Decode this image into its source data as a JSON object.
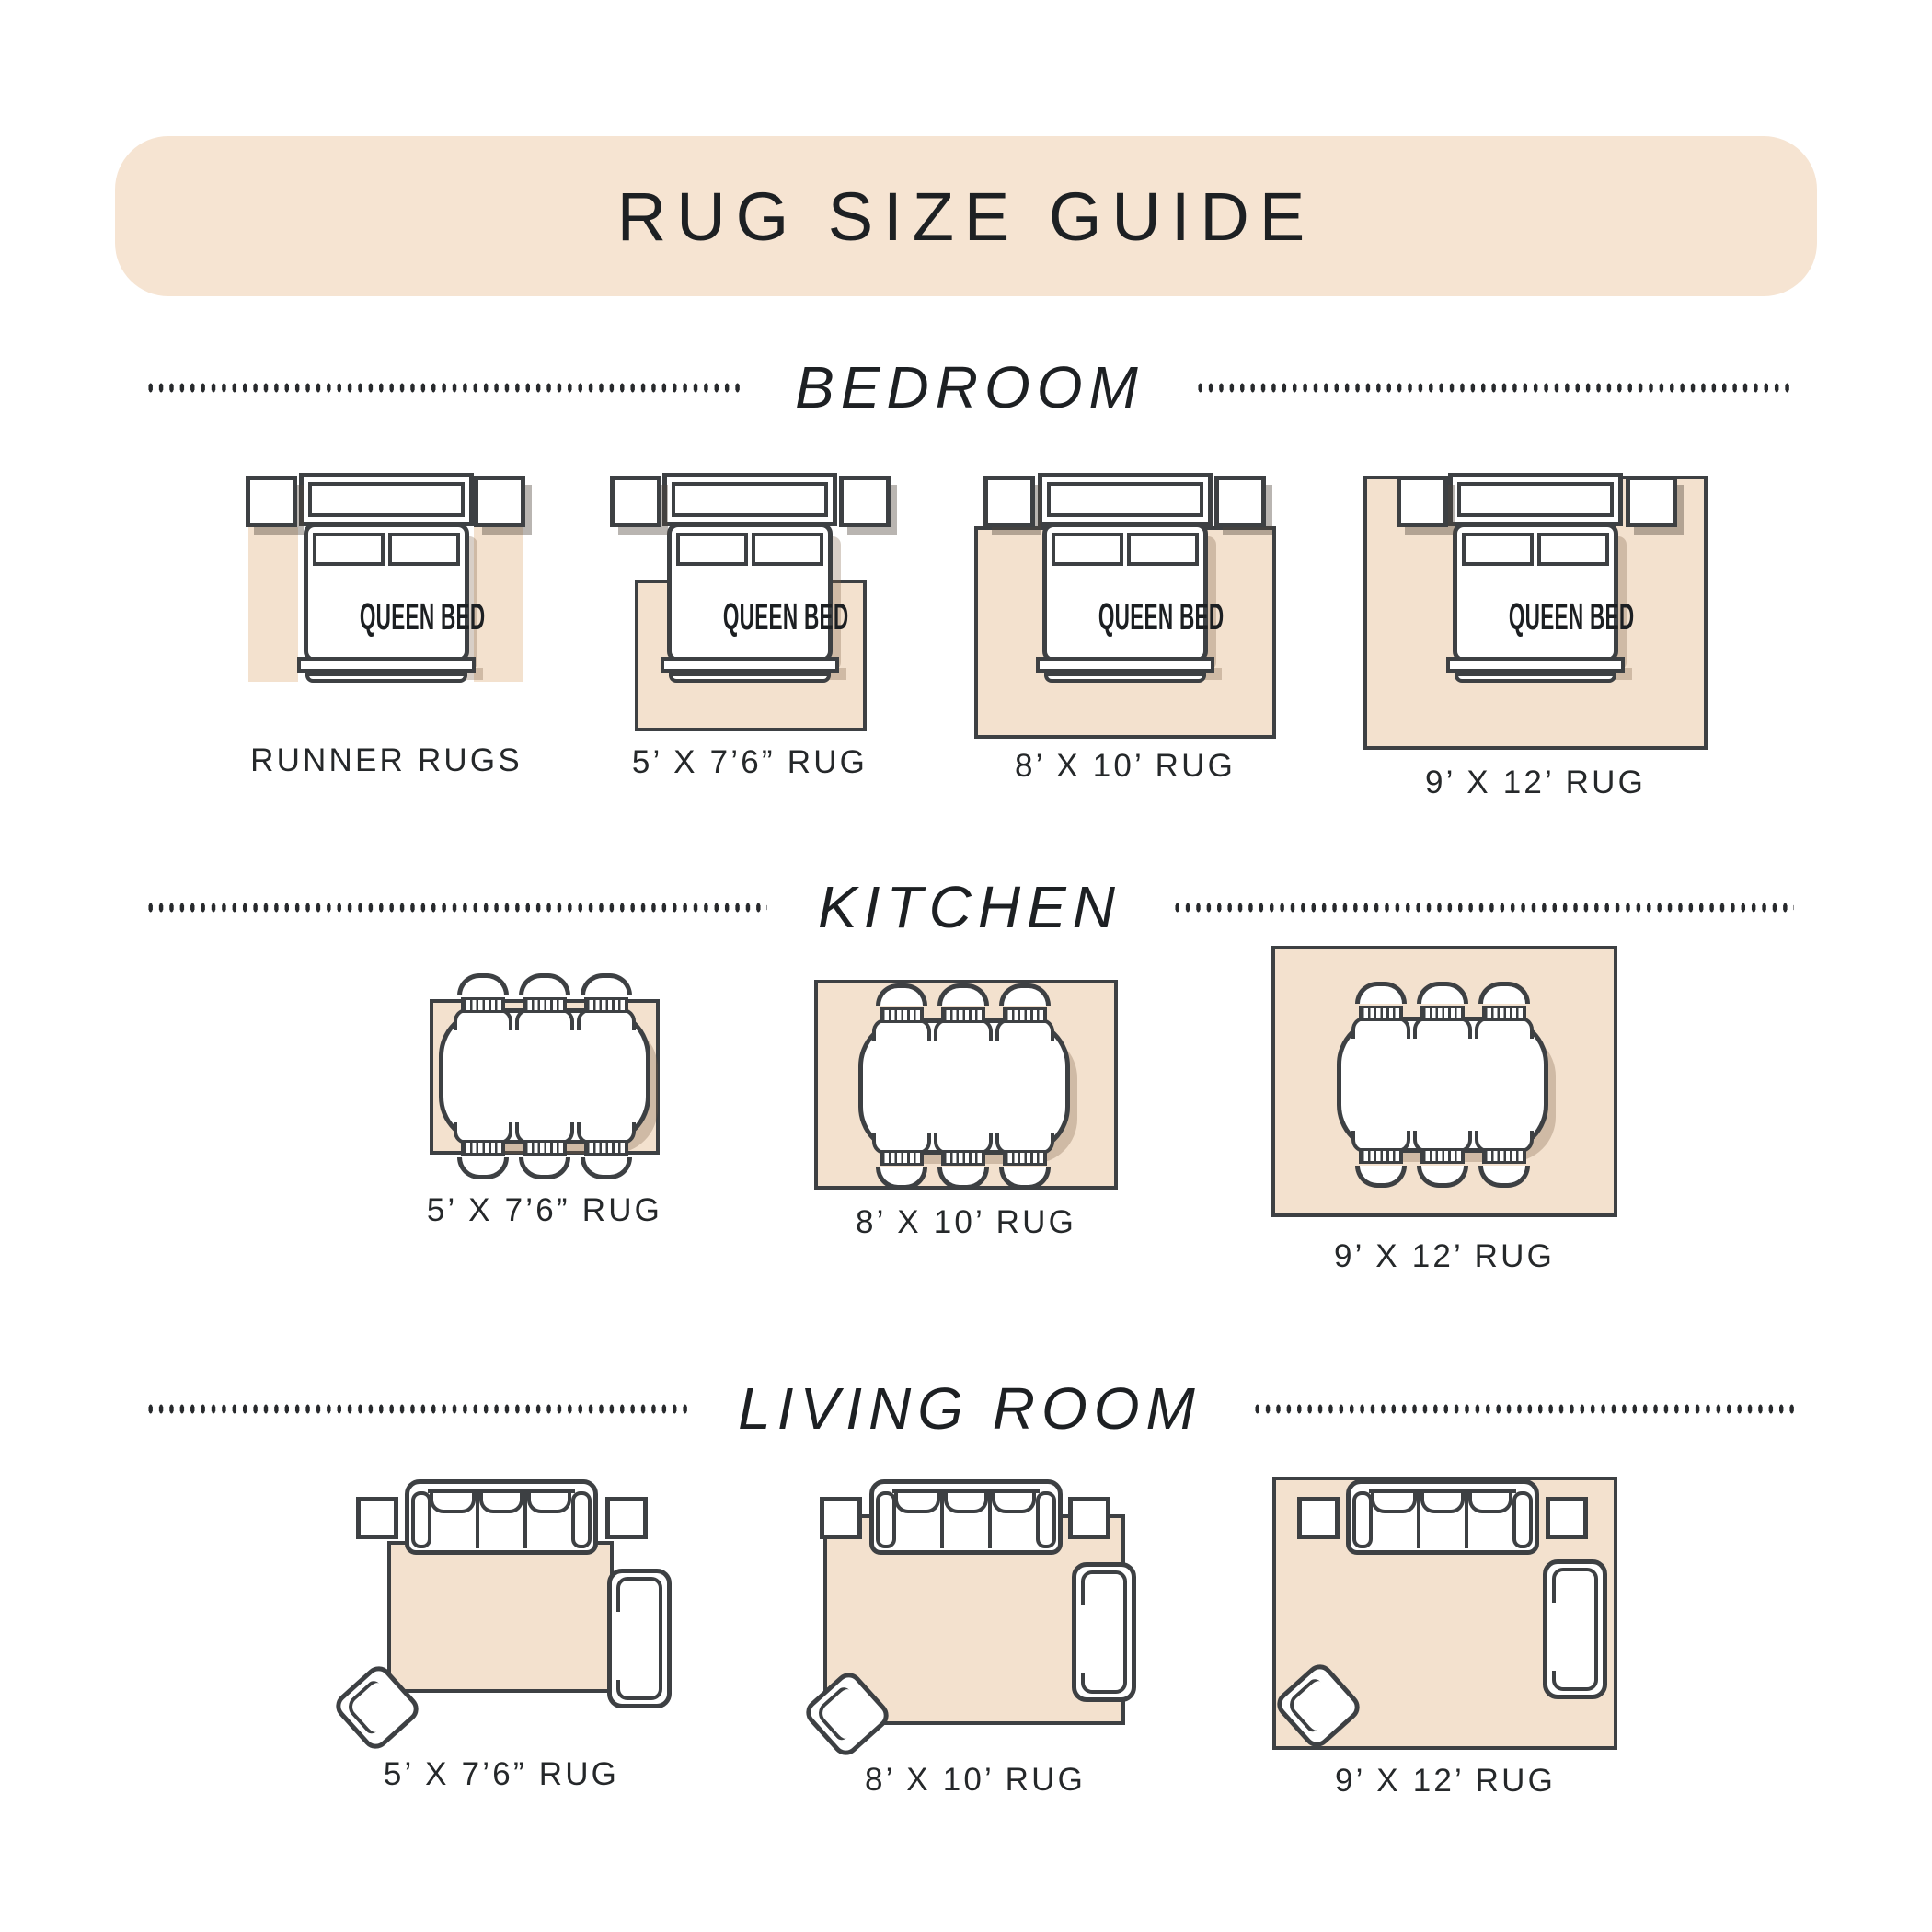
{
  "title": "RUG SIZE GUIDE",
  "bed_label": "QUEEN BED",
  "sections": [
    {
      "heading": "BEDROOM",
      "labels": [
        "RUNNER RUGS",
        "5’ X 7’6” RUG",
        "8’ X 10’ RUG",
        "9’ X 12’ RUG"
      ]
    },
    {
      "heading": "KITCHEN",
      "labels": [
        "5’ X 7’6” RUG",
        "8’ X 10’ RUG",
        "9’ X 12’ RUG"
      ]
    },
    {
      "heading": "LIVING ROOM",
      "labels": [
        "5’ X 7’6” RUG",
        "8’ X 10’ RUG",
        "9’ X 12’ RUG"
      ]
    }
  ],
  "colors": {
    "banner_beige": "#f6e4d2",
    "rug_beige": "#f3e1ce",
    "furniture_outline": "#3d4043",
    "text": "#212427"
  }
}
